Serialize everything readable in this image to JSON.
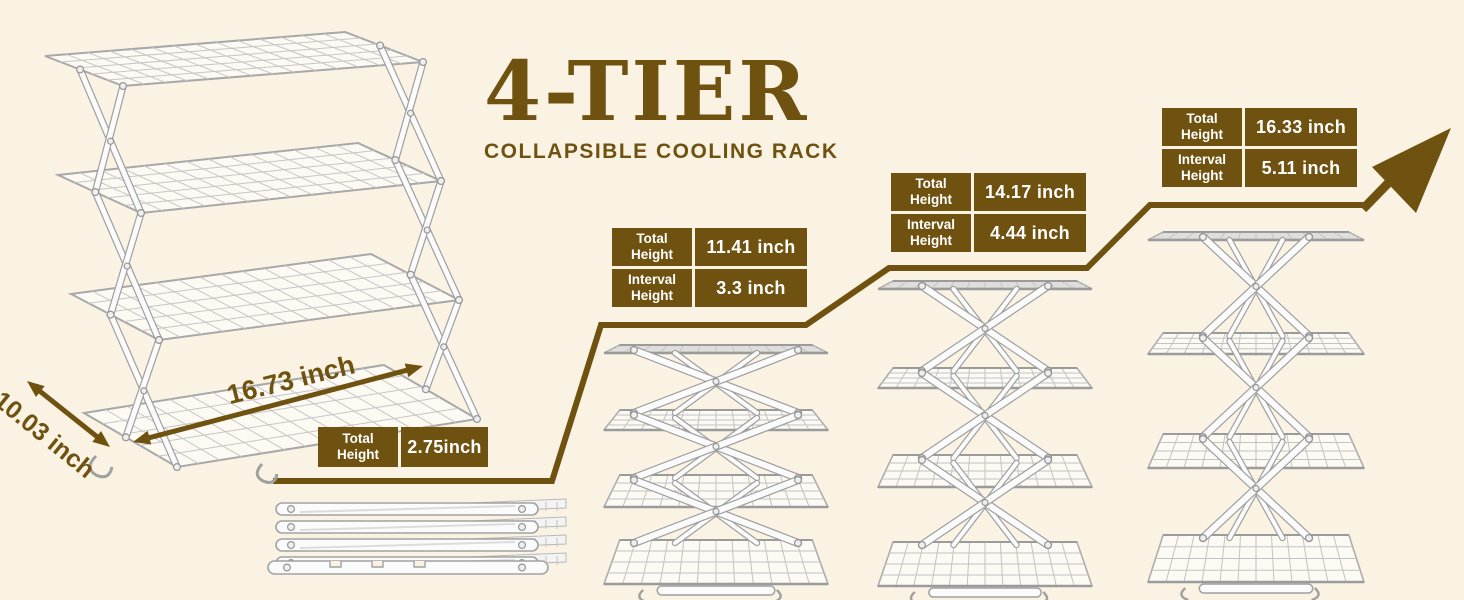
{
  "colors": {
    "background": "#faf3e4",
    "accent_brown": "#6f5210",
    "table_text": "#ffffff",
    "rack_metal": "#b5b5b5"
  },
  "header": {
    "title": "4-TIER",
    "subtitle": "COLLAPSIBLE COOLING RACK"
  },
  "product_view": {
    "depth_label": "10.03 inch",
    "width_label": "16.73 inch"
  },
  "stages": [
    {
      "id": "collapsed",
      "specs": [
        {
          "label": "Total Height",
          "value": "2.75inch"
        }
      ]
    },
    {
      "id": "stage-2",
      "specs": [
        {
          "label": "Total Height",
          "value": "11.41 inch"
        },
        {
          "label": "Interval Height",
          "value": "3.3 inch"
        }
      ]
    },
    {
      "id": "stage-3",
      "specs": [
        {
          "label": "Total Height",
          "value": "14.17 inch"
        },
        {
          "label": "Interval Height",
          "value": "4.44 inch"
        }
      ]
    },
    {
      "id": "stage-4",
      "specs": [
        {
          "label": "Total Height",
          "value": "16.33 inch"
        },
        {
          "label": "Interval Height",
          "value": "5.11 inch"
        }
      ]
    }
  ]
}
